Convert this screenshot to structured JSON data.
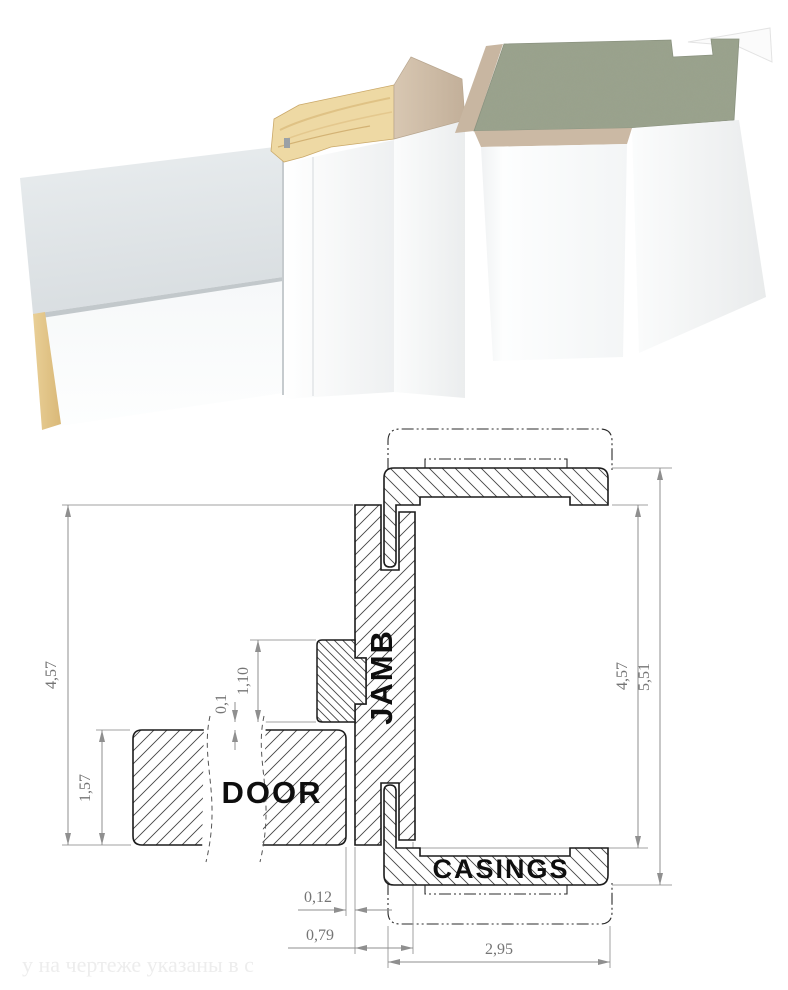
{
  "footnote": "у на чертеже указаны в с",
  "labels": {
    "door": "DOOR",
    "jamb": "JAMB",
    "casings": "CASINGS"
  },
  "dims": {
    "left_total": "4,57",
    "door_thickness": "1,57",
    "stop_width": "1,10",
    "stop_clearance": "0,1",
    "door_gap": "0,12",
    "jamb_depth": "0,79",
    "casing_width": "2,95",
    "right_opening": "4,57",
    "right_total": "5,51"
  },
  "colors": {
    "concrete": "#9aa28d",
    "wood": "#eed9a4",
    "beige": "#cbb9a4",
    "hatch": "#444444",
    "dimension": "#8f8f8f"
  }
}
